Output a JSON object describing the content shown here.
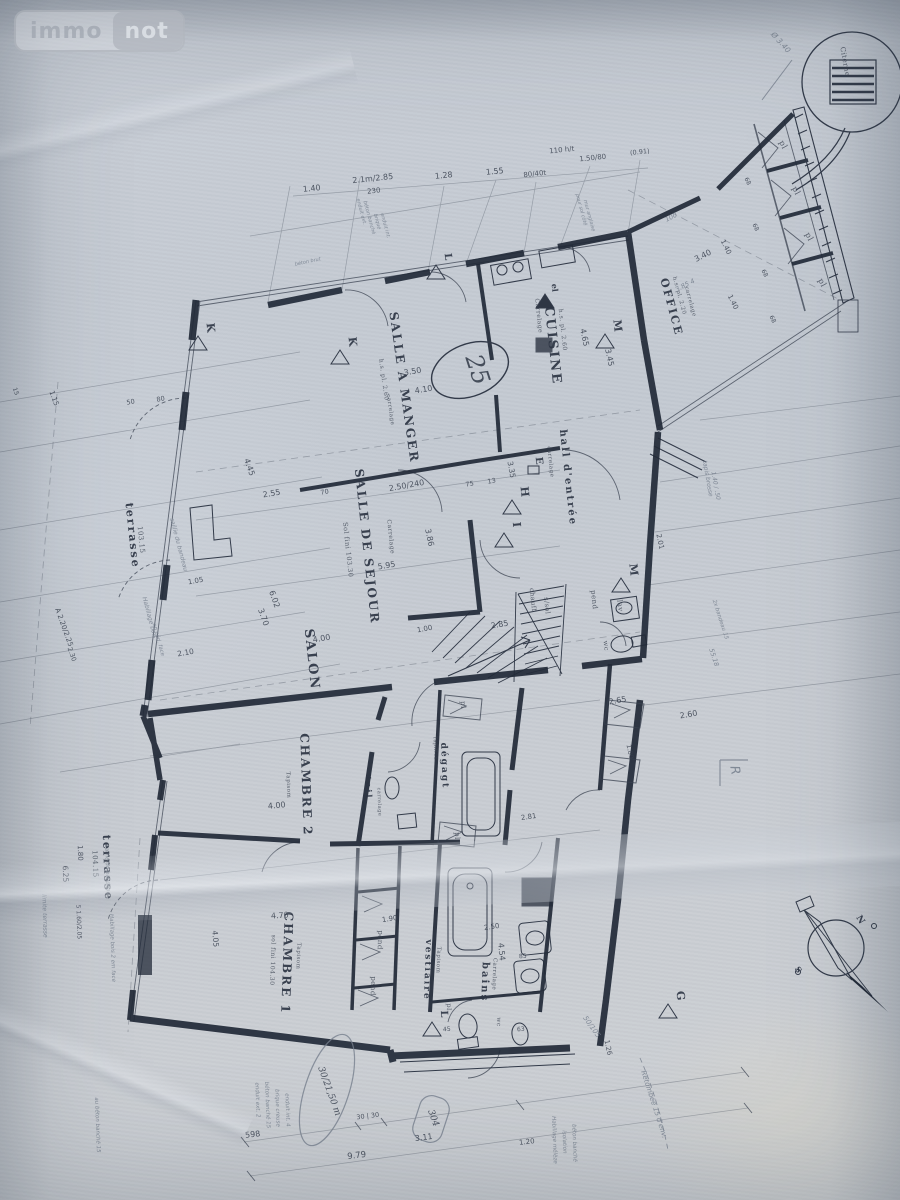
{
  "logo": {
    "immo": "immo",
    "not": "not"
  },
  "plan": {
    "ink_color": "#323a49",
    "wall_color": "#222a38",
    "pencil_color": "#77808d",
    "paper_color": "#c7ccd3",
    "circled_area_number": "25",
    "texts": {
      "cuisine": "CUISINE",
      "cuisine_sub1": "Carrelage",
      "cuisine_sub2": "h.s. pl. 2.60",
      "office": "OFFICE",
      "office_sub1": "carrelage",
      "office_sub2": "h.s. pl. 2.20",
      "salle_a_manger": "SALLE A MANGER",
      "sam_sub1": "h.s. pl. 2.60",
      "sam_sub2": "carrelage",
      "salle_de_sejour": "SALLE DE SEJOUR",
      "sds_sub1": "Carrelage",
      "sds_sub2": "Sol fini 103.30",
      "salon": "SALON",
      "hall": "hall d'entrée",
      "hall_sub": "carrelage",
      "chambre2": "CHAMBRE 2",
      "c2_sub": "Tapisom",
      "chambre1": "CHAMBRE 1",
      "c1_sub1": "Tapisom",
      "c1_sub2": "sol fini 104.30",
      "vestiaire": "vestiaire",
      "vest_sub": "Tapisom",
      "bains": "bains",
      "bains_sub": "Carrelage",
      "degagt": "dégagt",
      "degagt_sub": "Tapiflex",
      "toil": "toil",
      "toil_sub": "carrelage",
      "terrasse1": "terrasse",
      "terrasse1_n": "103.15",
      "terrasse2": "terrasse",
      "terrasse2_n": "104.15",
      "citerne": "Citerne",
      "chauff": "chauff",
      "soussol": "s/sol",
      "pend1": "pend",
      "pend2": "pend",
      "pend3": "pend",
      "lav": "lav",
      "wc1": "wc",
      "wc2": "wc",
      "pl_a": "pl",
      "pl_b": "pl",
      "pl_c": "pl",
      "pl_d": "pl",
      "pl_e": "pl",
      "pl_f": "pl",
      "pl_g": "pl",
      "K1": "K",
      "K2": "K",
      "M1": "M",
      "M2": "M",
      "L1": "L",
      "L2": "L",
      "H1": "H",
      "I1": "I",
      "E1": "E",
      "G1": "G",
      "R1": "R",
      "el": "el",
      "h25": "25",
      "h3021": "30/21,50 m",
      "h304": "304",
      "cN": "N",
      "cS": "S",
      "d140": "1.40",
      "d21m": "2.1m/2.85",
      "d230": "230",
      "d128": "1.28",
      "d155": "1.55",
      "d8040": "80/40t",
      "d110": "110 h/t",
      "d15080": "1.50/80",
      "d091": "(0.91)",
      "d345": "3.45",
      "d465": "4.65",
      "d350": "3.50",
      "d410": "4.10",
      "d250240": "2.50/240",
      "d75": "75",
      "d13": "13",
      "d70": "70",
      "d386": "3.86",
      "d595": "5.95",
      "d400s": "4.00",
      "d100": "1.00",
      "d285": "2.85",
      "d445": "4.45",
      "d255": "2.55",
      "d115": "1.15",
      "d50a": "50",
      "d80a": "80",
      "dA220": "A 2.20/2.25",
      "d230b": "2.30",
      "d105": "1.05",
      "d602": "6.02",
      "d370": "3.70",
      "d210": "2.10",
      "d180l": "1.80",
      "d625": "6.25",
      "d516": "5 1.60/2.05",
      "d340": "3.40",
      "d140b": "1.40",
      "d140c": "1.40",
      "d68a": "68",
      "d68b": "68",
      "d68c": "68",
      "d68d": "68",
      "d100p": "100",
      "d385": "3.85 4",
      "d265": "2.65",
      "d260": "2.60",
      "d201": "2.01",
      "d180r": "1.80",
      "d5518": "55.18",
      "d335": "3.35",
      "d470": "4.70",
      "d405": "4.05",
      "d400c": "4.00",
      "d281": "2.81",
      "d454": "4.54",
      "d250b": "2.50",
      "d190b": "1.90",
      "d45": "45",
      "d63": "63",
      "d85": "85",
      "d126": "1.26",
      "d120b": "1.20",
      "d311": "3.11",
      "d979": "9.79",
      "d598": "598",
      "d3030": "30 | 30",
      "d15": "15",
      "pDiam": "Ø 3.40",
      "pSail1": "saillie du bandeau",
      "pHab1": "Habillage bois",
      "pHab1b": "en céd. face",
      "pLim": "limite terrasse",
      "pSail2": "saillie du bandeau",
      "pHab2": "Habillage bois 2 em face",
      "pTapis": "tapis brosse",
      "pTapis2": "1.40 / .50",
      "pRet": "Retombée 15 d'env.",
      "p50105": "50/105",
      "pMel1": "Habillage mélèze",
      "pMel2": "isolation",
      "pMel3": "béton banché",
      "pCol1": "enduit ext. 2",
      "pCol2": "béton banché 15",
      "pCol3": "brique creuse",
      "pCol4": "enduit int. 4",
      "pCol5": "au béton banché 15",
      "pW1": "enduit ext.",
      "pW2": "béton banché",
      "pW3": "brique",
      "pW4": "enduit int.",
      "pPour1": "pour sol côté",
      "pPour2": "mur anglaise",
      "pBrut": "béton brut",
      "pBand": "2x bandeau 15"
    }
  }
}
